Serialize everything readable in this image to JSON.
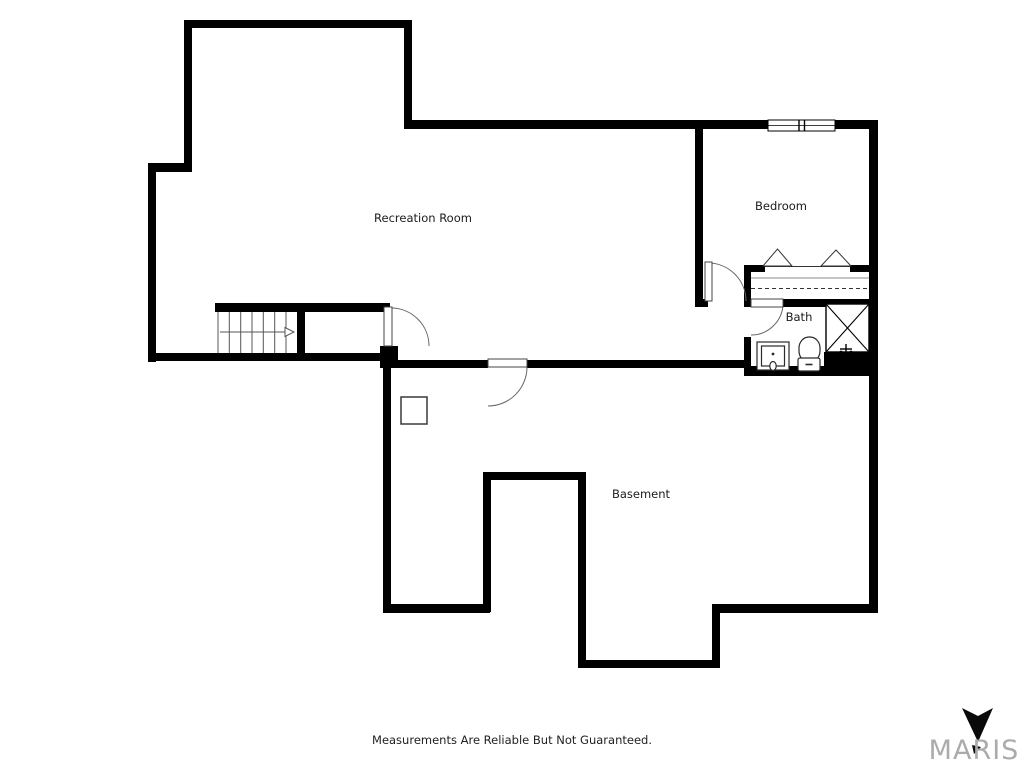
{
  "floorplan": {
    "wall_color": "#000000",
    "rooms": [
      {
        "id": "recreation-room",
        "label": "Recreation Room"
      },
      {
        "id": "bedroom",
        "label": "Bedroom"
      },
      {
        "id": "bath",
        "label": "Bath"
      },
      {
        "id": "basement",
        "label": "Basement"
      }
    ],
    "symbols": [
      "stairs-with-up-arrow",
      "door-swing",
      "bifold-closet-doors",
      "closet-hanging-rod",
      "double-window",
      "shower-stall",
      "toilet",
      "vanity-sink",
      "support-post"
    ]
  },
  "footer": {
    "disclaimer": "Measurements Are Reliable But Not Guaranteed."
  },
  "logo": {
    "text": "MARIS",
    "color": "#ababab"
  }
}
